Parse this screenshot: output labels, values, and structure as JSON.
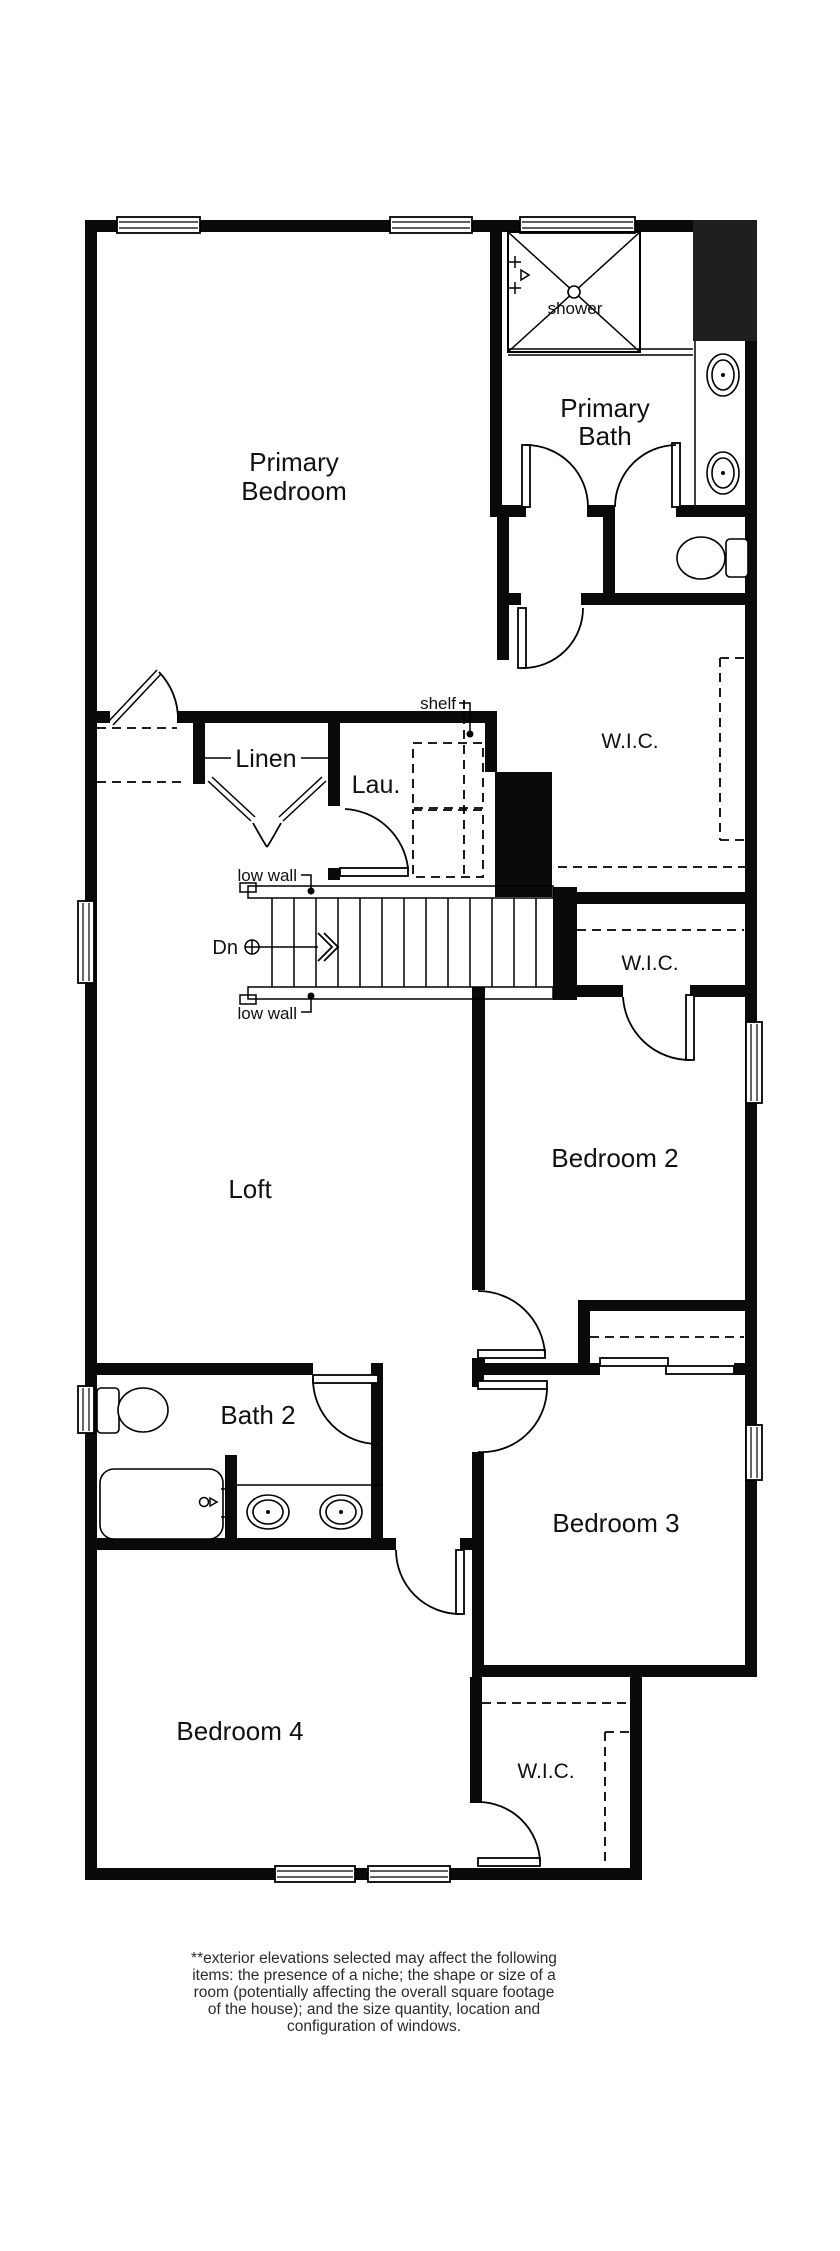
{
  "colors": {
    "background": "#ffffff",
    "wall": "#0a0a0a",
    "chase_fill": "#1f1f1f",
    "line": "#000000",
    "label_text": "#111111",
    "disclaimer_text": "#2b2b2b"
  },
  "rooms": {
    "primary_bedroom": {
      "label_line1": "Primary",
      "label_line2": "Bedroom"
    },
    "primary_bath": {
      "label_line1": "Primary",
      "label_line2": "Bath"
    },
    "wic_primary": {
      "label": "W.I.C."
    },
    "wic_bedroom2": {
      "label": "W.I.C."
    },
    "wic_bedroom4": {
      "label": "W.I.C."
    },
    "loft": {
      "label": "Loft"
    },
    "bedroom2": {
      "label": "Bedroom 2"
    },
    "bedroom3": {
      "label": "Bedroom 3"
    },
    "bedroom4": {
      "label": "Bedroom 4"
    },
    "bath2": {
      "label": "Bath 2"
    },
    "linen": {
      "label": "Linen"
    },
    "laundry": {
      "label": "Lau."
    }
  },
  "annotations": {
    "shower": "shower",
    "shelf": "shelf",
    "low_wall_top": "low wall",
    "low_wall_bottom": "low wall",
    "stairs_direction": "Dn"
  },
  "disclaimer": {
    "line1": "**exterior elevations selected may affect the following",
    "line2": "items: the presence of a niche; the shape or size of a",
    "line3": "room (potentially affecting the overall square footage",
    "line4": "of the house); and the size quantity, location and",
    "line5": "configuration of windows."
  }
}
